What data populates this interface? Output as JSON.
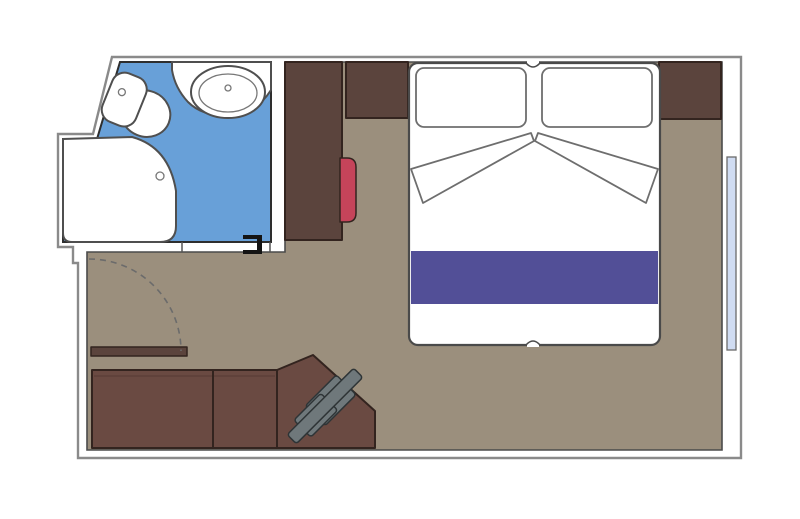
{
  "plan": {
    "name": "Cabin floor plan",
    "rooms": [
      {
        "name": "bathroom",
        "features": [
          "shower",
          "washbasin",
          "toilet",
          "sliding-door"
        ]
      },
      {
        "name": "cabin",
        "features": [
          "double-bed",
          "pillow-left",
          "pillow-right",
          "bed-runner",
          "folded-sheets",
          "wardrobe",
          "nightstand-left",
          "nightstand-right",
          "stool",
          "desk",
          "desk-chair",
          "entry-door",
          "window"
        ]
      }
    ]
  },
  "colors": {
    "background": "#ffffff",
    "wall_fill": "#ffffff",
    "floor": "#9b8f7d",
    "bathroom_floor": "#68a0d8",
    "fixture_white": "#ffffff",
    "furniture_dark": "#5b443d",
    "desk_brown": "#6a4a42",
    "stool_red": "#c5445a",
    "bed_white": "#ffffff",
    "bed_runner": "#524f97",
    "chair_gray": "#6f787b",
    "window_glass": "#d0dcf2",
    "door_arc": "#6b6b6b",
    "door_mark": "#141414"
  }
}
